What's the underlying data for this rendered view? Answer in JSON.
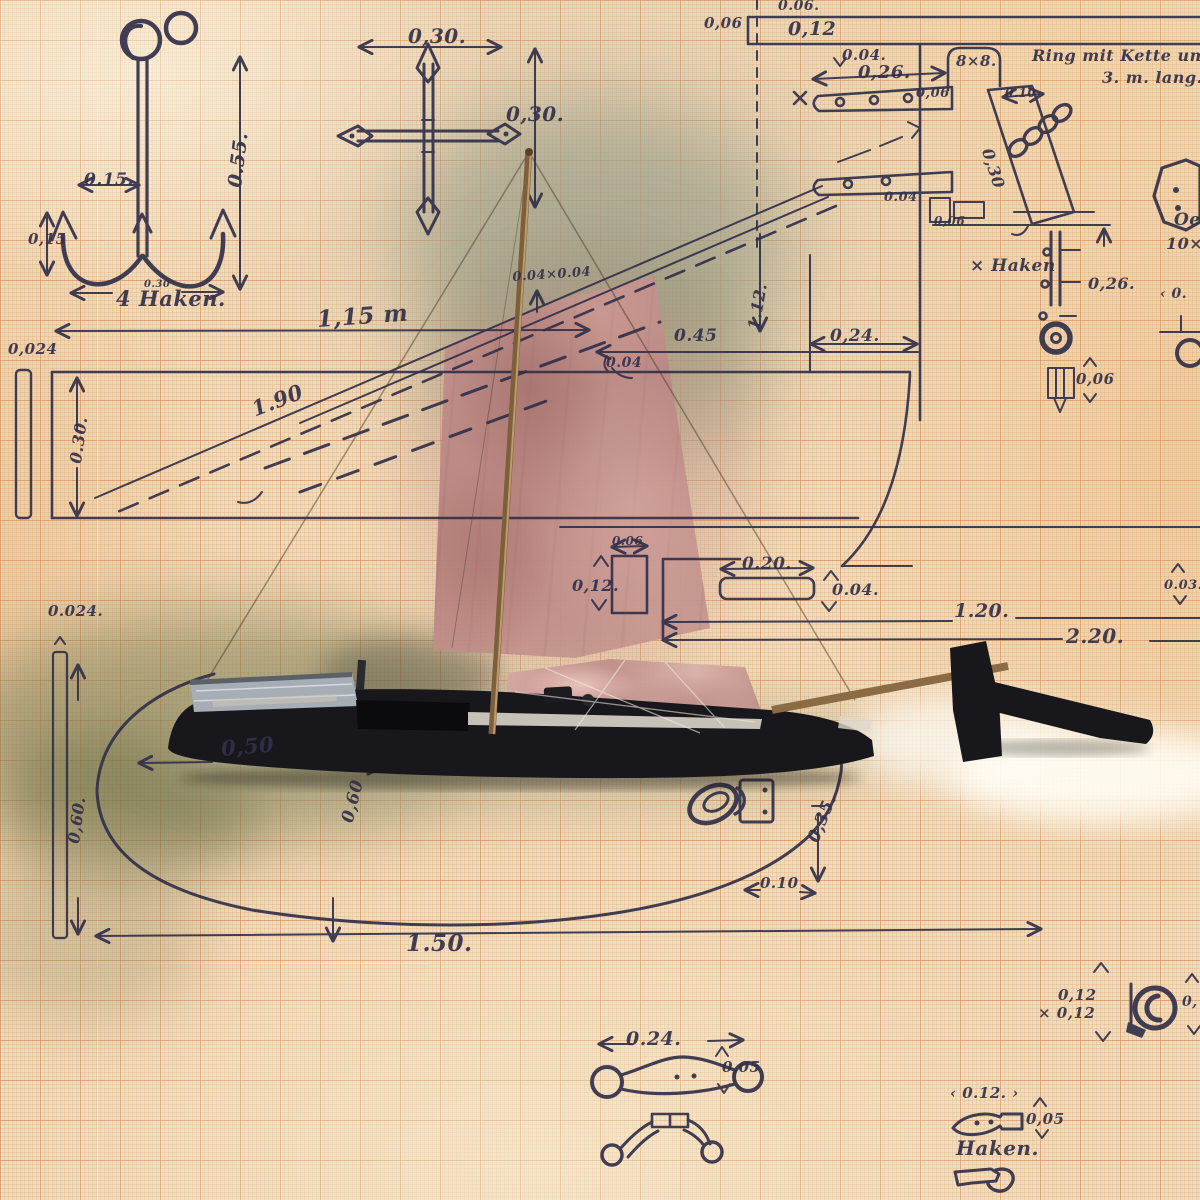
{
  "palette": {
    "paper": "#eedcbc",
    "grid": "#d3743a",
    "ink": "#32304a",
    "sail": "#c59490",
    "tarp": "#c1918b",
    "hull": "#17171c",
    "mast": "#7d5f3c",
    "foliage": "#787a50"
  },
  "labels": [
    {
      "text": "0.15.",
      "x": 84,
      "y": 170,
      "size": 17
    },
    {
      "text": "0.55.",
      "x": 224,
      "y": 186,
      "size": 19,
      "r": -83
    },
    {
      "text": "0,15",
      "x": 28,
      "y": 230,
      "size": 15
    },
    {
      "text": "0.30",
      "x": 144,
      "y": 279,
      "size": 10
    },
    {
      "text": "4 Haken.",
      "x": 116,
      "y": 286,
      "size": 21,
      "n": "note-vier-haken"
    },
    {
      "text": "0,30.",
      "x": 408,
      "y": 24,
      "size": 20
    },
    {
      "text": "0,30.",
      "x": 506,
      "y": 102,
      "size": 20
    },
    {
      "text": "0,06",
      "x": 704,
      "y": 14,
      "size": 15
    },
    {
      "text": "0.06.",
      "x": 778,
      "y": -2,
      "size": 14
    },
    {
      "text": "0,12",
      "x": 788,
      "y": 18,
      "size": 19
    },
    {
      "text": "0.04.",
      "x": 842,
      "y": 46,
      "size": 15
    },
    {
      "text": "0,26.",
      "x": 858,
      "y": 62,
      "size": 18
    },
    {
      "text": "8×8.",
      "x": 956,
      "y": 52,
      "size": 15
    },
    {
      "text": "0,06",
      "x": 916,
      "y": 86,
      "size": 13
    },
    {
      "text": "0.10",
      "x": 1005,
      "y": 86,
      "size": 12
    },
    {
      "text": "0,30",
      "x": 996,
      "y": 146,
      "size": 16,
      "r": 72
    },
    {
      "text": "0.04",
      "x": 884,
      "y": 190,
      "size": 13
    },
    {
      "text": "0,06",
      "x": 934,
      "y": 214,
      "size": 12
    },
    {
      "text": "Ring mit Kette und Stec",
      "x": 1032,
      "y": 46,
      "size": 16,
      "n": "note-ring-kette"
    },
    {
      "text": "3. m. lang.",
      "x": 1102,
      "y": 68,
      "size": 16,
      "n": "note-ring-kette-laenge"
    },
    {
      "text": "× Haken",
      "x": 970,
      "y": 256,
      "size": 17,
      "n": "note-haken-marker"
    },
    {
      "text": "Oe",
      "x": 1174,
      "y": 210,
      "size": 17,
      "n": "note-oese"
    },
    {
      "text": "10×",
      "x": 1166,
      "y": 234,
      "size": 16,
      "n": "note-oese-2"
    },
    {
      "text": "0,26.",
      "x": 1088,
      "y": 274,
      "size": 16
    },
    {
      "text": "0,06",
      "x": 1076,
      "y": 370,
      "size": 15
    },
    {
      "text": "‹ 0.",
      "x": 1160,
      "y": 286,
      "size": 14
    },
    {
      "text": "1,15 m",
      "x": 316,
      "y": 306,
      "size": 23,
      "r": -4
    },
    {
      "text": "0.04×0.04",
      "x": 512,
      "y": 270,
      "size": 13,
      "r": -4
    },
    {
      "text": "0.45",
      "x": 674,
      "y": 326,
      "size": 17
    },
    {
      "text": "0.04",
      "x": 606,
      "y": 355,
      "size": 14
    },
    {
      "text": "0,24.",
      "x": 830,
      "y": 326,
      "size": 17
    },
    {
      "text": "1.12.",
      "x": 744,
      "y": 328,
      "size": 16,
      "r": -80
    },
    {
      "text": "0,024",
      "x": 8,
      "y": 340,
      "size": 15
    },
    {
      "text": "0.30.",
      "x": 66,
      "y": 462,
      "size": 16,
      "r": -82
    },
    {
      "text": "1.90",
      "x": 248,
      "y": 398,
      "size": 21,
      "r": -21
    },
    {
      "text": "0.06",
      "x": 612,
      "y": 534,
      "size": 12
    },
    {
      "text": "0,12.",
      "x": 572,
      "y": 576,
      "size": 16
    },
    {
      "text": "0.20.",
      "x": 742,
      "y": 554,
      "size": 17
    },
    {
      "text": "0.04.",
      "x": 832,
      "y": 580,
      "size": 16
    },
    {
      "text": "1.20.",
      "x": 954,
      "y": 600,
      "size": 19
    },
    {
      "text": "2.20.",
      "x": 1066,
      "y": 624,
      "size": 20
    },
    {
      "text": "0.03.",
      "x": 1164,
      "y": 578,
      "size": 13
    },
    {
      "text": "0.024.",
      "x": 48,
      "y": 602,
      "size": 15
    },
    {
      "text": "0,60.",
      "x": 64,
      "y": 842,
      "size": 16,
      "r": -82
    },
    {
      "text": "0,50",
      "x": 220,
      "y": 736,
      "size": 21,
      "r": -5
    },
    {
      "text": "0,60",
      "x": 338,
      "y": 820,
      "size": 17,
      "r": -76
    },
    {
      "text": "0,35.",
      "x": 804,
      "y": 838,
      "size": 17,
      "r": -68
    },
    {
      "text": "0.10",
      "x": 760,
      "y": 874,
      "size": 15
    },
    {
      "text": "1.50.",
      "x": 406,
      "y": 930,
      "size": 23
    },
    {
      "text": "0.24.",
      "x": 626,
      "y": 1028,
      "size": 19
    },
    {
      "text": "0,05",
      "x": 722,
      "y": 1058,
      "size": 15
    },
    {
      "text": "0,12",
      "x": 1058,
      "y": 986,
      "size": 15
    },
    {
      "text": "× 0,12",
      "x": 1038,
      "y": 1004,
      "size": 15
    },
    {
      "text": "0,",
      "x": 1182,
      "y": 994,
      "size": 14
    },
    {
      "text": "‹ 0.12. ›",
      "x": 950,
      "y": 1084,
      "size": 15
    },
    {
      "text": "0,05",
      "x": 1026,
      "y": 1110,
      "size": 15
    },
    {
      "text": "Haken.",
      "x": 956,
      "y": 1136,
      "size": 20,
      "n": "note-haken-bottom"
    }
  ]
}
